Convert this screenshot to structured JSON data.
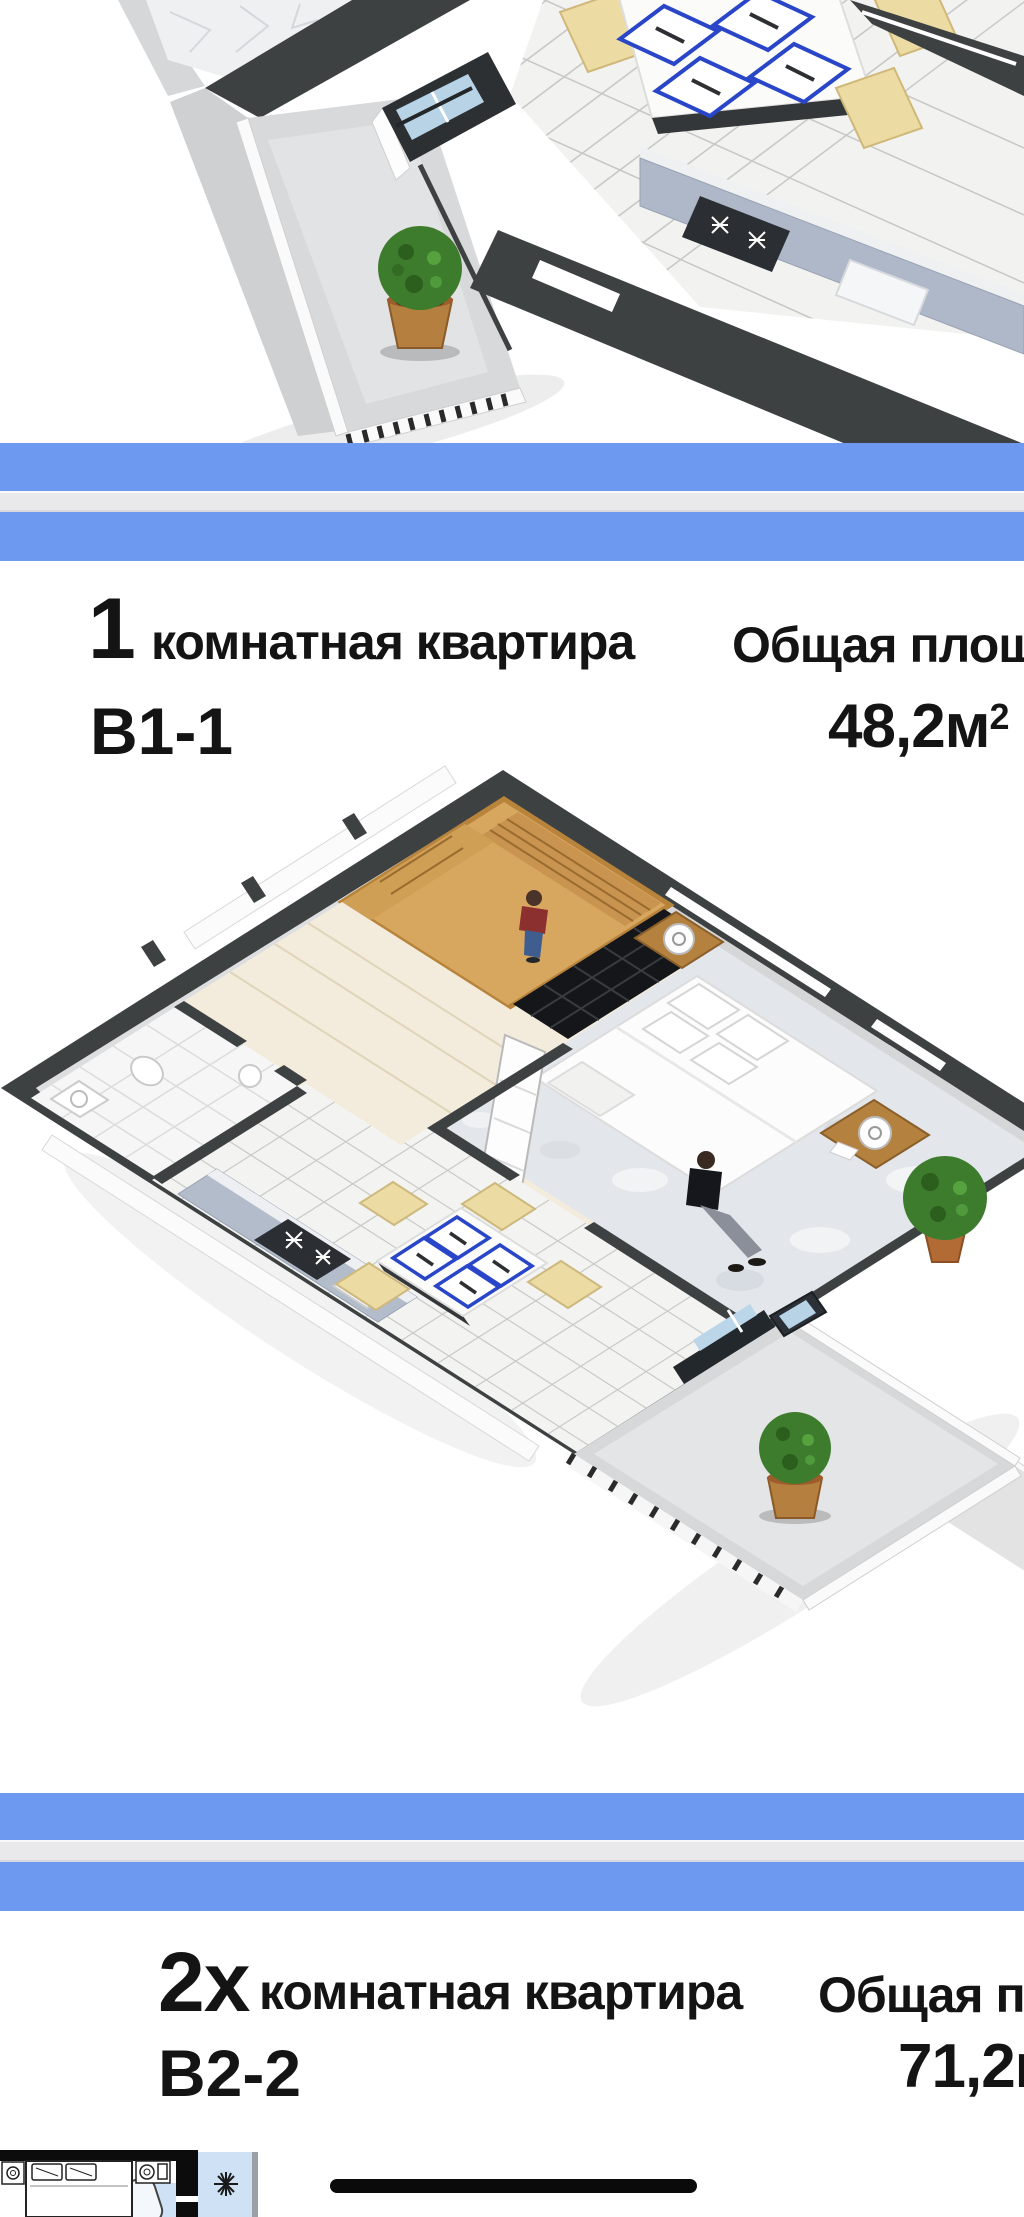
{
  "page": {
    "width": 1024,
    "height": 2217,
    "background": "#ffffff"
  },
  "apartments": [
    {
      "number": "1",
      "type_label": "комнатная квартира",
      "code": "В1-1",
      "area_label": "Общая площадь",
      "area_value": "48,2м",
      "area_sup": "2"
    },
    {
      "number": "2х",
      "type_label": "комнатная квартира",
      "code": "В2-2",
      "area_label": "Общая площадь",
      "area_value": "71,2м",
      "area_sup": "2"
    }
  ],
  "divider": {
    "stripe_blue": "#6e99f0",
    "middle_gray": "#e9e9ec"
  },
  "palette": {
    "wall_dark": "#3e4142",
    "wall_face_gray": "#d6d7d8",
    "floor_wood_light": "#f3ecdc",
    "wardrobe_wood": "#d8a75f",
    "bookshelf_black": "#17191c",
    "carpet_gray": "#e3e6ea",
    "tile_white": "#f3f3f1",
    "tile_line": "#c7c8c6",
    "kitchen_cabinet_blue": "#aeb8c8",
    "window_glass_blue": "#b9d3e6",
    "plant_green": "#3e7c2d",
    "plant_pot": "#b5803f",
    "placemat_blue": "#2946c9",
    "chair_cream": "#ecdca4",
    "plan2d_room_blue": "#cfe1f5",
    "separator_black": "#0a0a0a"
  },
  "icons": [
    "potted-plant-icon",
    "stove-burner-icon",
    "plant-star-icon",
    "person-figure-icon"
  ]
}
